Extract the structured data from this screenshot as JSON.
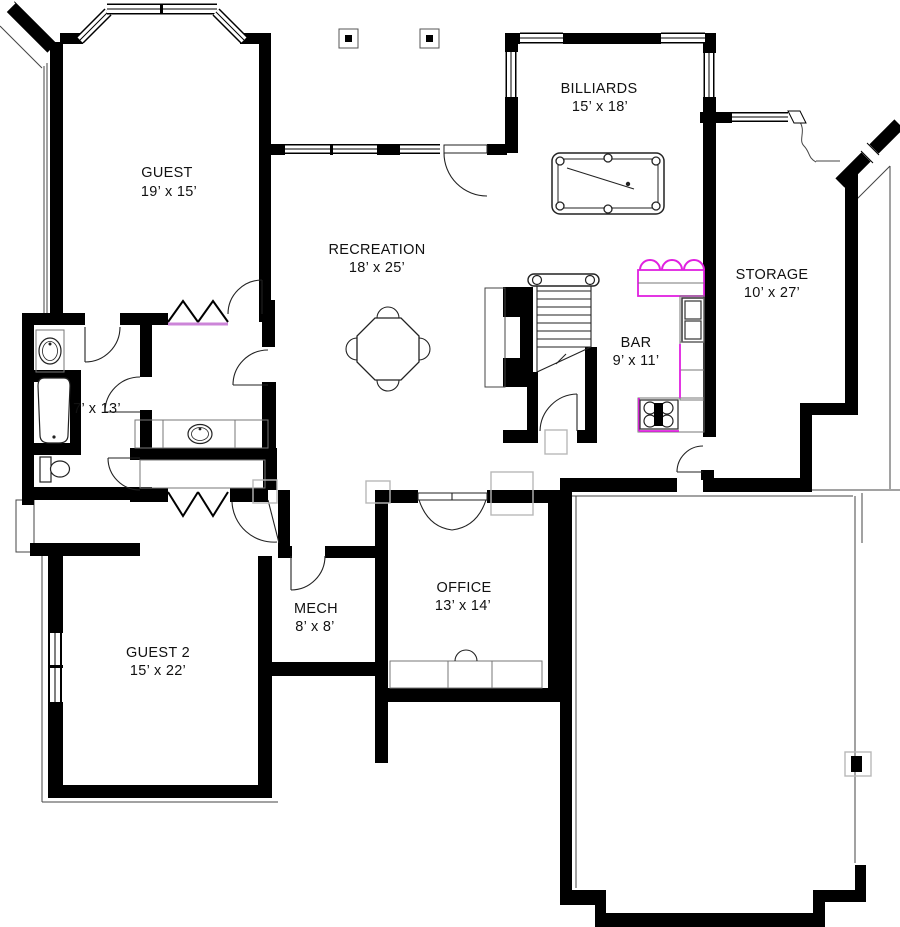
{
  "plan": {
    "title": "Basement floor plan",
    "rooms": [
      {
        "id": "guest",
        "name": "GUEST",
        "dims": "19’ x 15’"
      },
      {
        "id": "recreation",
        "name": "RECREATION",
        "dims": "18’ x 25’"
      },
      {
        "id": "billiards",
        "name": "BILLIARDS",
        "dims": "15’ x 18’"
      },
      {
        "id": "storage",
        "name": "STORAGE",
        "dims": "10’ x 27’"
      },
      {
        "id": "bar",
        "name": "BAR",
        "dims": "9’ x 11’"
      },
      {
        "id": "bathroom",
        "name": "",
        "dims": "7’ x 13’"
      },
      {
        "id": "mech",
        "name": "MECH",
        "dims": "8’ x 8’"
      },
      {
        "id": "office",
        "name": "OFFICE",
        "dims": "13’ x 14’"
      },
      {
        "id": "guest2",
        "name": "GUEST 2",
        "dims": "15’ x 22’"
      }
    ],
    "symbols": [
      "pool-table",
      "game-table-with-chairs",
      "staircase",
      "bar-stools",
      "bar-counter",
      "refrigerator",
      "cooktop-4-burner",
      "bathtub",
      "toilet",
      "oval-sink",
      "vanity-counter",
      "built-in-desk",
      "desk-chair",
      "bifold-closet-doors",
      "door-swing",
      "window",
      "deck-post-marker",
      "column-footing-marker",
      "wall-break-symbol"
    ],
    "colors": {
      "wall": "#000000",
      "magenta_accent": "#e020e0",
      "violet_accent": "#cc85d8",
      "counter_line": "#777777",
      "foundation_line": "#444444",
      "marker_gray": "#b8b8b8",
      "text": "#111111",
      "background": "#ffffff"
    }
  }
}
